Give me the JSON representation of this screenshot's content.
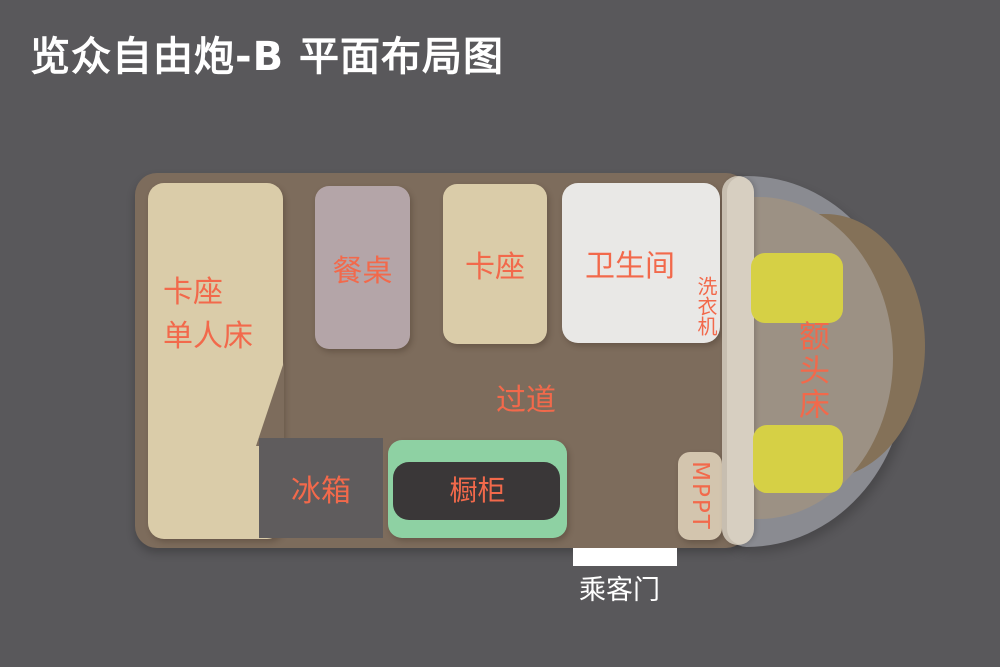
{
  "title": "览众自由炮-B 平面布局图",
  "floorplan": {
    "bed_booth": {
      "line1": "卡座",
      "line2": "单人床"
    },
    "dining_table": {
      "label": "餐桌"
    },
    "booth": {
      "label": "卡座"
    },
    "bathroom": {
      "label": "卫生间"
    },
    "washing_machine": {
      "label": "洗衣机"
    },
    "aisle": {
      "label": "过道"
    },
    "fridge": {
      "label": "冰箱"
    },
    "cabinet": {
      "label": "橱柜"
    },
    "mppt": {
      "label": "MPPT"
    },
    "overhead_bed": {
      "label": "额头床"
    },
    "passenger_door": {
      "label": "乘客门"
    }
  },
  "colors": {
    "background": "#59585b",
    "title_text": "#ffffff",
    "label_accent": "#f2694b",
    "van_body": "#7d6c5c",
    "bed_beige": "#dacca9",
    "dining_table": "#b4a5a8",
    "bathroom": "#e9e8e6",
    "fridge": "#5f5c5d",
    "cabinet_frame": "#8ed1a3",
    "cabinet_counter": "#3a3738",
    "mppt_box": "#d3c5ae",
    "pillar": "#d7cfc1",
    "cab_floor": "#9c9184",
    "windshield": "#8a8b91",
    "van_nose": "#847158",
    "seat_yellow": "#d6d045",
    "door_white": "#ffffff"
  }
}
